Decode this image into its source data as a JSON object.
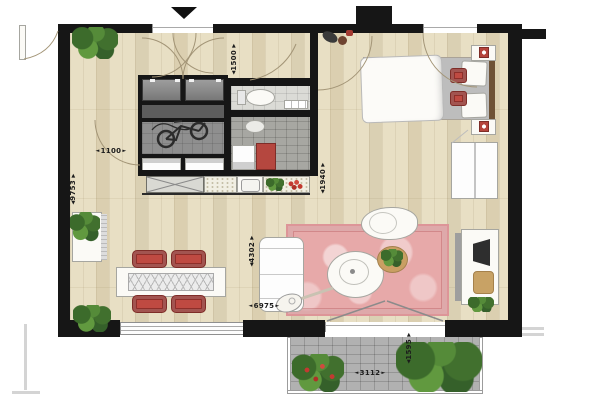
{
  "arrows": {
    "left": "◄",
    "right": "►",
    "up": "▲",
    "down": "▼"
  },
  "dimensions": {
    "hall_width": {
      "value": "1100"
    },
    "left_total": {
      "value": "9753"
    },
    "entry_depth": {
      "value": "1500"
    },
    "bedroom_pass": {
      "value": "1940"
    },
    "living_depth": {
      "value": "4302"
    },
    "living_width": {
      "value": "6975"
    },
    "balcony_width": {
      "value": "3112"
    },
    "balcony_depth": {
      "value": "1595"
    }
  },
  "colors": {
    "wall": "#161616",
    "wood_floor": "#e8dfc4",
    "rug_pink": "#e7a9a9",
    "accent_red": "#bf4a42",
    "plant_green": "#4e7a35",
    "balcony_paver": "#b1b1b1",
    "tile_light": "#dbdbd6",
    "tile_dark": "#a7a7a2"
  }
}
